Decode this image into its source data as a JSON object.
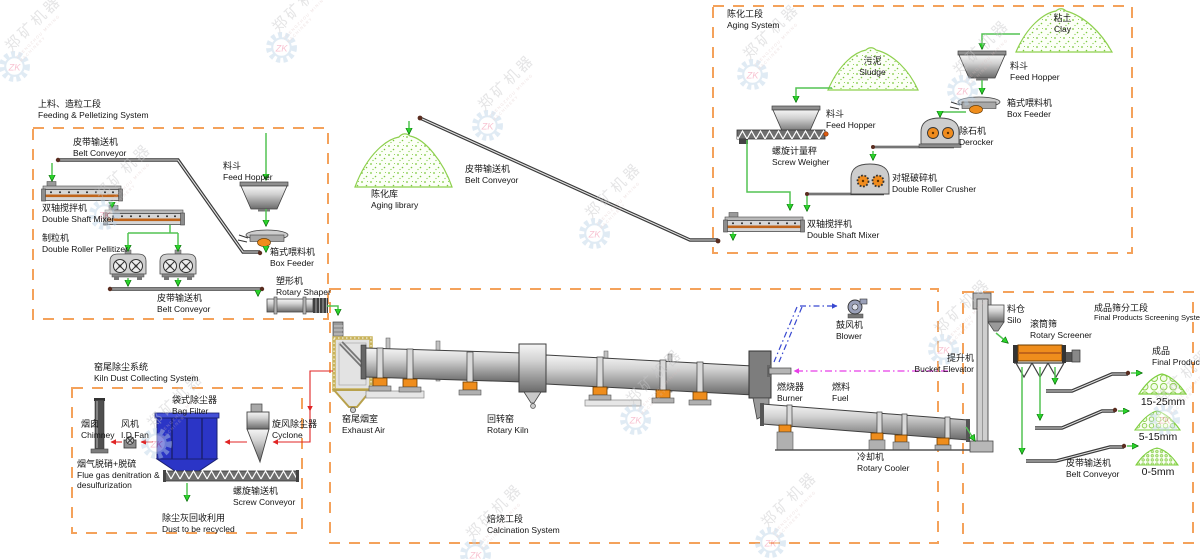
{
  "watermark": {
    "logo": "ZK",
    "brand_cn": "郑矿机器",
    "brand_en": "ZHENGZHOU MINING MACHINERY"
  },
  "sections": {
    "feeding": {
      "cn": "上料、造粒工段",
      "en": "Feeding & Pelletizing System"
    },
    "aging": {
      "cn": "陈化工段",
      "en": "Aging System"
    },
    "kiln_dust": {
      "cn": "窑尾除尘系统",
      "en": "Kiln Dust Collecting System"
    },
    "calcination": {
      "cn": "焙烧工段",
      "en": "Calcination System"
    },
    "screening": {
      "cn": "成品筛分工段",
      "en": "Final Products Screening System"
    }
  },
  "labels": {
    "belt_conveyor_1": {
      "cn": "皮带输送机",
      "en": "Belt Conveyor"
    },
    "double_shaft_mixer_1": {
      "cn": "双轴搅拌机",
      "en": "Double Shaft Mixer"
    },
    "pellitizer": {
      "cn": "制粒机",
      "en": "Double Roller Pellitizer"
    },
    "feed_hopper_1": {
      "cn": "料斗",
      "en": "Feed Hopper"
    },
    "box_feeder_1": {
      "cn": "箱式喂料机",
      "en": "Box Feeder"
    },
    "belt_conveyor_2": {
      "cn": "皮带输送机",
      "en": "Belt Conveyor"
    },
    "rotary_shaper": {
      "cn": "塑形机",
      "en": "Rotary Shaper"
    },
    "aging_library": {
      "cn": "陈化库",
      "en": "Aging library"
    },
    "belt_conveyor_3": {
      "cn": "皮带输送机",
      "en": "Belt Conveyor"
    },
    "sludge": {
      "cn": "污泥",
      "en": "Sludge"
    },
    "feed_hopper_2": {
      "cn": "料斗",
      "en": "Feed Hopper"
    },
    "screw_weigher": {
      "cn": "螺旋计量秤",
      "en": "Screw Weigher"
    },
    "clay": {
      "cn": "粘土",
      "en": "Clay"
    },
    "feed_hopper_3": {
      "cn": "料斗",
      "en": "Feed Hopper"
    },
    "box_feeder_2": {
      "cn": "箱式喂料机",
      "en": "Box Feeder"
    },
    "derocker": {
      "cn": "除石机",
      "en": "Derocker"
    },
    "double_roller_crusher": {
      "cn": "对辊破碎机",
      "en": "Double Roller Crusher"
    },
    "double_shaft_mixer_2": {
      "cn": "双轴搅拌机",
      "en": "Double Shaft Mixer"
    },
    "chimney": {
      "cn": "烟囱",
      "en": "Chimney"
    },
    "id_fan": {
      "cn": "风机",
      "en": "I.D.Fan"
    },
    "bag_filter": {
      "cn": "袋式除尘器",
      "en": "Bag Filter"
    },
    "cyclone": {
      "cn": "旋风除尘器",
      "en": "Cyclone"
    },
    "flue_gas": {
      "cn": "烟气脱硝+脱硫",
      "en": "Flue gas denitration & desulfurization"
    },
    "screw_conveyor": {
      "cn": "螺旋输送机",
      "en": "Screw Conveyor"
    },
    "dust_recycled": {
      "cn": "除尘灰回收利用",
      "en": "Dust to be recycled"
    },
    "exhaust_air": {
      "cn": "窑尾烟室",
      "en": "Exhaust Air"
    },
    "rotary_kiln": {
      "cn": "回转窑",
      "en": "Rotary Kiln"
    },
    "blower": {
      "cn": "鼓风机",
      "en": "Blower"
    },
    "burner": {
      "cn": "燃烧器",
      "en": "Burner"
    },
    "fuel": {
      "cn": "燃料",
      "en": "Fuel"
    },
    "rotary_cooler": {
      "cn": "冷却机",
      "en": "Rotary Cooler"
    },
    "bucket_elevator": {
      "cn": "提升机",
      "en": "Bucket Elevator"
    },
    "silo": {
      "cn": "料仓",
      "en": "Silo"
    },
    "rotary_screener": {
      "cn": "滚筒筛",
      "en": "Rotary Screener"
    },
    "final_products": {
      "cn": "成品",
      "en": "Final Products"
    },
    "size_large": "15-25mm",
    "size_medium": "5-15mm",
    "size_small": "0-5mm",
    "belt_conveyor_4": {
      "cn": "皮带输送机",
      "en": "Belt Conveyor"
    }
  },
  "colors": {
    "section_border": "#F4A25B",
    "flow_arrow_green": "#2BD42B",
    "dust_flow_red": "#E02525",
    "fuel_line_magenta": "#E83DE8",
    "air_line_blue": "#3848D0",
    "bag_filter_blue": "#2B35C6",
    "machine_accent_orange": "#EF8D1C"
  }
}
